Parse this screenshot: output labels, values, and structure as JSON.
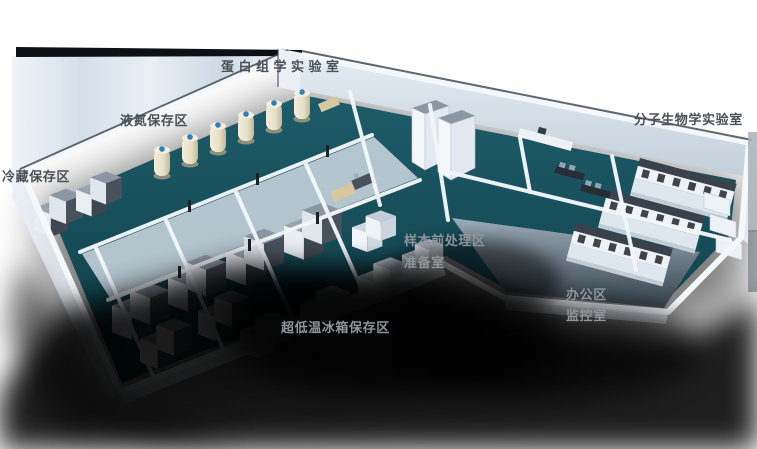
{
  "scene": {
    "type": "3d-isometric-lab-floorplan",
    "background": "#ffffff"
  },
  "labels": {
    "proteomics": {
      "text": "蛋白组学实验室"
    },
    "liquid_nitrogen": {
      "text": "液氮保存区"
    },
    "cold_storage": {
      "text": "冷藏保存区"
    },
    "molecular_biology": {
      "text": "分子生物学实验室"
    },
    "sample_pretreatment": {
      "text": "样本前处理区"
    },
    "prep_room": {
      "text": "准备室"
    },
    "office": {
      "text": "办公区"
    },
    "monitoring": {
      "text": "监控室"
    },
    "ult_freezer": {
      "text": "超低温冰箱保存区"
    }
  },
  "colors": {
    "floor_teal": "#17505c",
    "wall_light": "#f3f7fa",
    "wall_shade": "#ccd8e3",
    "roof_band_dark": "#0d1115",
    "shadow": "#000000",
    "freezer_gray": "#98a3ae",
    "freezer_side_dark": "#3e474f",
    "tank_cream": "#eae2cb",
    "tank_cap_blue": "#2f7fc1",
    "bench_top_dark": "#39414a",
    "office_floor_gray": "#9fadb9",
    "label_dark": "#4a5056",
    "label_light": "#8e959b"
  }
}
